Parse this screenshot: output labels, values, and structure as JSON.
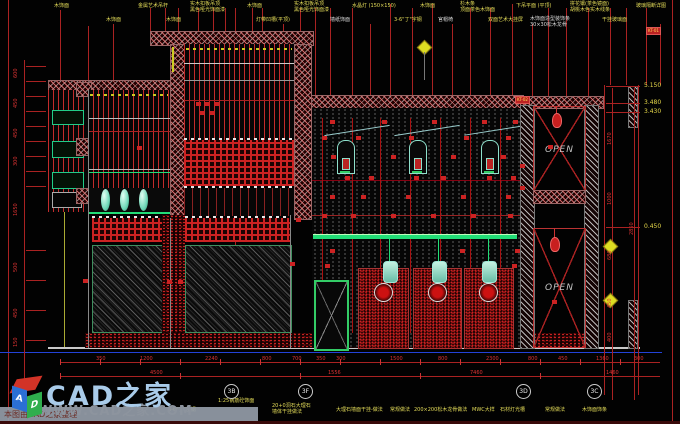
{
  "watermark": {
    "brand": "CAD之家",
    "url": "WWW.CAD之家.COM",
    "note": "本图由CAD之家整理",
    "logo_letter_a": "A",
    "logo_letter_d": "D",
    "brand_color": "#a9cbe9"
  },
  "open_label": "OPEN",
  "tags": [
    {
      "t": "KT-02",
      "x": 515,
      "y": 96
    },
    {
      "t": "KT-01",
      "x": 646,
      "y": 27
    }
  ],
  "top_labels": [
    {
      "t": "木饰面",
      "x": 54,
      "y": 3
    },
    {
      "t": "金属艺术吊杆",
      "x": 138,
      "y": 3
    },
    {
      "t": "实木扣板吊顶\n黑色哑光饰面漆",
      "x": 190,
      "y": 1
    },
    {
      "t": "木饰面",
      "x": 247,
      "y": 3
    },
    {
      "t": "实木扣板吊顶\n黑色哑光饰面漆",
      "x": 294,
      "y": 1
    },
    {
      "t": "水晶灯 (150×150)",
      "x": 352,
      "y": 3
    },
    {
      "t": "木饰面",
      "x": 420,
      "y": 3
    },
    {
      "t": "杉木条\n顶面茶色木饰面",
      "x": 460,
      "y": 1
    },
    {
      "t": "下吊平面 (平顶)",
      "x": 516,
      "y": 3
    },
    {
      "t": "拼花镶(茶色镜面)\n胡桃木色实木线条",
      "x": 570,
      "y": 1
    },
    {
      "t": "玻璃隔断详图",
      "x": 636,
      "y": 3
    },
    {
      "t": "木饰面",
      "x": 106,
      "y": 17
    },
    {
      "t": "木饰面",
      "x": 166,
      "y": 17
    },
    {
      "t": "灯带凹槽(平顶)",
      "x": 256,
      "y": 17
    },
    {
      "t": "墙纸饰面",
      "x": 330,
      "y": 17,
      "c": "#dddddd"
    },
    {
      "t": "3-6\"丁\"字钢",
      "x": 394,
      "y": 17
    },
    {
      "t": "官帽椅",
      "x": 438,
      "y": 17,
      "c": "#dddddd"
    },
    {
      "t": "双面艺术大挂屏",
      "x": 488,
      "y": 17
    },
    {
      "t": "木饰面造型装饰条\n30×30松木龙骨",
      "x": 530,
      "y": 16,
      "c": "#dddddd"
    },
    {
      "t": "干挂玻璃面",
      "x": 602,
      "y": 17
    }
  ],
  "bottom_labels": [
    {
      "t": "3-6\"丁\"字钢",
      "x": 168,
      "y": 407
    },
    {
      "t": "1:25钢筋砼饰面",
      "x": 218,
      "y": 398
    },
    {
      "t": "20+0洞石大理石\n墙体干挂做法",
      "x": 272,
      "y": 403
    },
    {
      "t": "大理石墙面干挂-做法",
      "x": 336,
      "y": 407
    },
    {
      "t": "常规做法",
      "x": 390,
      "y": 407
    },
    {
      "t": "200×200松木龙骨做法",
      "x": 414,
      "y": 407
    },
    {
      "t": "MWC大样",
      "x": 472,
      "y": 407
    },
    {
      "t": "石材灯光槽",
      "x": 500,
      "y": 407
    },
    {
      "t": "常规做法",
      "x": 545,
      "y": 407
    },
    {
      "t": "木饰面饰条",
      "x": 582,
      "y": 407
    }
  ],
  "left_dims": [
    {
      "t": "600",
      "x": 13,
      "y": 78
    },
    {
      "t": "450",
      "x": 13,
      "y": 108
    },
    {
      "t": "450",
      "x": 13,
      "y": 138
    },
    {
      "t": "300",
      "x": 13,
      "y": 166
    },
    {
      "t": "1650",
      "x": 13,
      "y": 216
    },
    {
      "t": "500",
      "x": 13,
      "y": 272
    },
    {
      "t": "450",
      "x": 13,
      "y": 318
    },
    {
      "t": "150",
      "x": 13,
      "y": 347
    }
  ],
  "right_dims": [
    {
      "t": "1670",
      "x": 607,
      "y": 145
    },
    {
      "t": "1000",
      "x": 607,
      "y": 205
    },
    {
      "t": "680",
      "x": 607,
      "y": 260
    },
    {
      "t": "450",
      "x": 607,
      "y": 308
    },
    {
      "t": "400",
      "x": 607,
      "y": 342
    },
    {
      "t": "2850",
      "x": 629,
      "y": 235
    }
  ],
  "elevations": [
    {
      "t": "5.150",
      "y": 86
    },
    {
      "t": "3.480",
      "y": 103
    },
    {
      "t": "3.430",
      "y": 112
    },
    {
      "t": "0.450",
      "y": 227
    }
  ],
  "bottom_dims": [
    {
      "t": "350",
      "x": 96,
      "y": 356
    },
    {
      "t": "1200",
      "x": 140,
      "y": 356
    },
    {
      "t": "2240",
      "x": 205,
      "y": 356
    },
    {
      "t": "800",
      "x": 262,
      "y": 356
    },
    {
      "t": "700",
      "x": 292,
      "y": 356
    },
    {
      "t": "350",
      "x": 316,
      "y": 356
    },
    {
      "t": "300",
      "x": 336,
      "y": 356
    },
    {
      "t": "1500",
      "x": 390,
      "y": 356
    },
    {
      "t": "800",
      "x": 438,
      "y": 356
    },
    {
      "t": "2300",
      "x": 486,
      "y": 356
    },
    {
      "t": "800",
      "x": 528,
      "y": 356
    },
    {
      "t": "450",
      "x": 558,
      "y": 356
    },
    {
      "t": "1360",
      "x": 596,
      "y": 356
    },
    {
      "t": "300",
      "x": 634,
      "y": 356
    },
    {
      "t": "4500",
      "x": 150,
      "y": 370
    },
    {
      "t": "1556",
      "x": 328,
      "y": 370
    },
    {
      "t": "7460",
      "x": 470,
      "y": 370
    },
    {
      "t": "1460",
      "x": 606,
      "y": 370
    }
  ],
  "grid_bubbles": [
    {
      "t": "3B",
      "x": 224
    },
    {
      "t": "3F",
      "x": 298
    },
    {
      "t": "3D",
      "x": 516
    },
    {
      "t": "3C",
      "x": 587
    }
  ]
}
